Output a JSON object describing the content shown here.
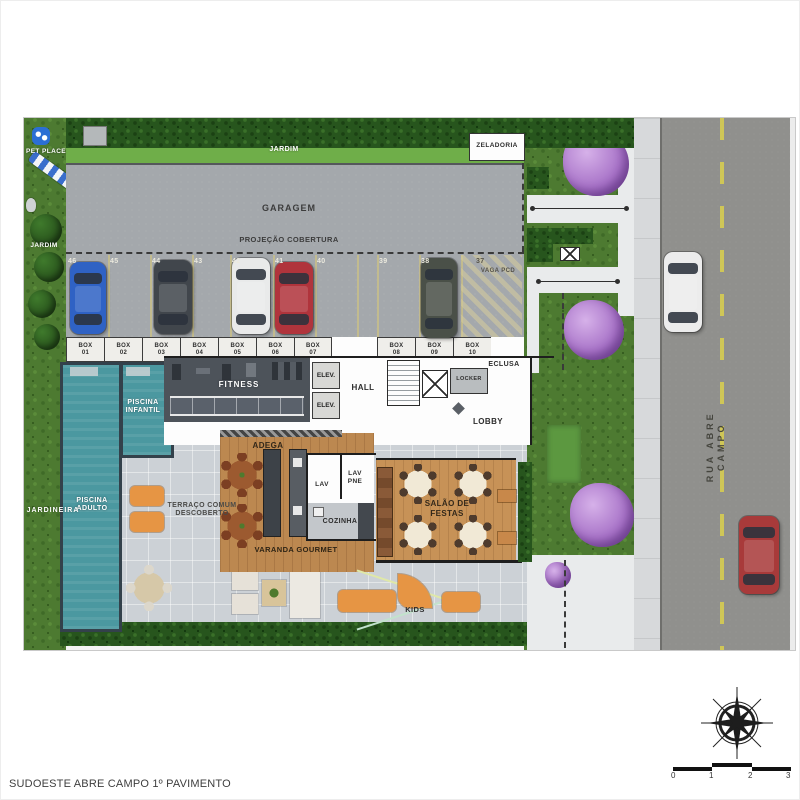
{
  "footer": {
    "title": "SUDOESTE ABRE CAMPO 1º PAVIMENTO"
  },
  "labels": {
    "jardim_top": "JARDIM",
    "jardim_left": "JARDIM",
    "jardineira": "JARDINEIRA",
    "pet_place": "PET PLACE",
    "zeladoria": "ZELADORIA",
    "garagem": "GARAGEM",
    "projecao_cobertura": "PROJEÇÃO COBERTURA",
    "vaga_pcd": "VAGA PCD",
    "fitness": "FITNESS",
    "elev_1": "ELEV.",
    "elev_2": "ELEV.",
    "hall": "HALL",
    "locker": "LOCKER",
    "eclusa": "ECLUSA",
    "lobby": "LOBBY",
    "adega": "ADEGA",
    "terraco": "TERRAÇO COMUM DESCOBERTO",
    "varanda_gourmet": "VARANDA GOURMET",
    "cozinha": "COZINHA",
    "lav": "LAV",
    "lav_pne": "LAV PNE",
    "salao_festas": "SALÃO DE FESTAS",
    "kids": "KIDS",
    "piscina_infantil": "PISCINA INFANTIL",
    "piscina_adulto": "PISCINA ADULTO",
    "rua": "RUA ABRE CAMPO"
  },
  "parking": {
    "numbers": [
      "46",
      "45",
      "44",
      "43",
      "42",
      "41",
      "40",
      "39",
      "38",
      "37"
    ]
  },
  "boxes": [
    {
      "t": "BOX",
      "n": "01"
    },
    {
      "t": "BOX",
      "n": "02"
    },
    {
      "t": "BOX",
      "n": "03"
    },
    {
      "t": "BOX",
      "n": "04"
    },
    {
      "t": "BOX",
      "n": "05"
    },
    {
      "t": "BOX",
      "n": "06"
    },
    {
      "t": "BOX",
      "n": "07"
    },
    {
      "t": "BOX",
      "n": "08"
    },
    {
      "t": "BOX",
      "n": "09"
    },
    {
      "t": "BOX",
      "n": "10"
    }
  ],
  "cars": {
    "garage": [
      {
        "space": "46",
        "color": "#2f62c4"
      },
      {
        "space": "44",
        "color": "#41464c"
      },
      {
        "space": "42",
        "color": "#e9eaea"
      },
      {
        "space": "41",
        "color": "#b0343c"
      },
      {
        "space": "38",
        "color": "#4a5048"
      }
    ],
    "street": [
      {
        "color": "#ececec"
      },
      {
        "color": "#a83a3a"
      }
    ]
  },
  "scale_bar": {
    "ticks": [
      "0",
      "1",
      "2",
      "3"
    ]
  },
  "colors": {
    "pool": "#4b98a0",
    "wood": "#bc8850",
    "lawn": "#4d7a31",
    "hedge": "#27551d",
    "garage_concrete": "#a4a8ac",
    "street_asphalt": "#90908d",
    "centerline_yellow": "#cfc657",
    "purple_tree": "#a873c8",
    "kids_orange": "#e69544"
  }
}
